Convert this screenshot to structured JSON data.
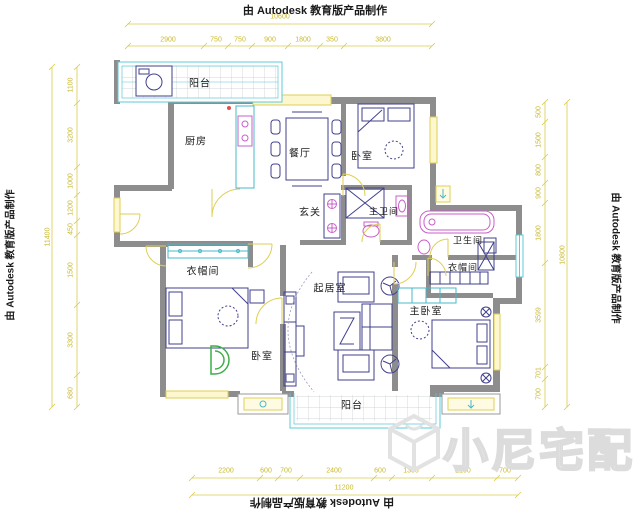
{
  "stamp": "由 Autodesk 教育版产品制作",
  "brand": "小尼宅配",
  "rooms": {
    "balcony_top": "阳台",
    "kitchen": "厨房",
    "dining": "餐厅",
    "bedroom_top": "卧室",
    "foyer": "玄关",
    "master_bath": "主卫间",
    "bathroom": "卫生间",
    "cloakroom_right": "衣帽间",
    "cloakroom_left": "衣帽间",
    "living": "起居室",
    "bedroom_left": "卧室",
    "master_bedroom": "主卧室",
    "balcony_bottom": "阳台"
  },
  "dimensions": {
    "top_total": "10600",
    "top_segments": [
      "2900",
      "750",
      "750",
      "900",
      "1800",
      "350",
      "3800"
    ],
    "bottom_segments": [
      "2200",
      "600",
      "700",
      "2400",
      "600",
      "1300",
      "2100",
      "700"
    ],
    "bottom_total": "11200",
    "left_total": "11400",
    "left_segments": [
      "1100",
      "3200",
      "1000",
      "1200",
      "450",
      "1500",
      "3300",
      "680"
    ],
    "right_segments": [
      "500",
      "1500",
      "800",
      "900",
      "1800",
      "3599",
      "701",
      "700"
    ],
    "right_total": "10800"
  },
  "colors": {
    "dimension": "#d9cb4a",
    "wall": "#8d8d8d",
    "window_teal": "#5cc8d8",
    "fixture_pink": "#c85fc8",
    "furniture": "#40408c",
    "accent_green": "#3fae49",
    "watermark": "#e6e6e6"
  }
}
